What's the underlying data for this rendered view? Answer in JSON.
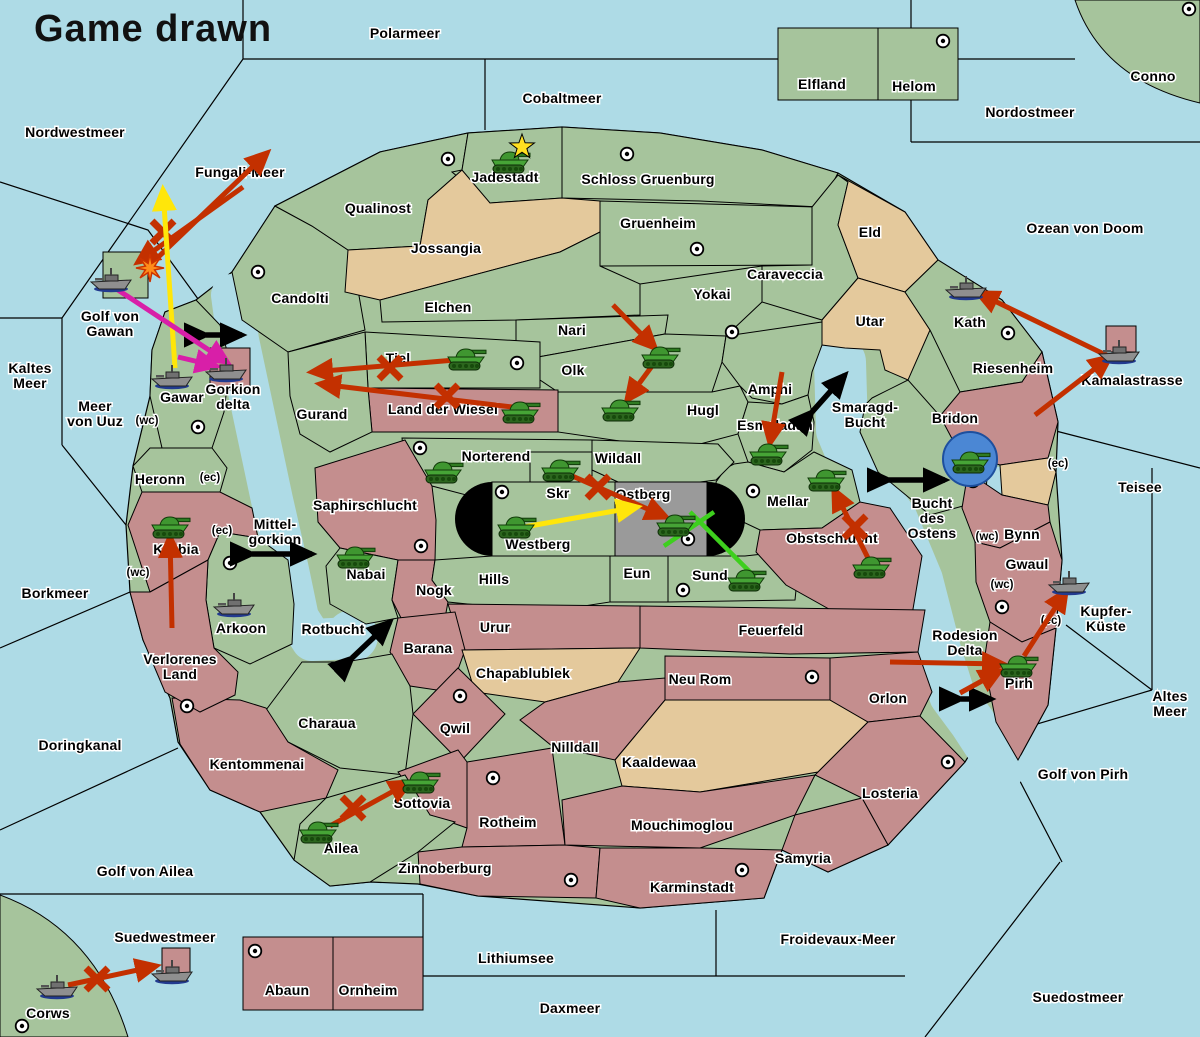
{
  "title": "Game drawn",
  "colors": {
    "ocean": "#aedbe6",
    "land_green": "#a6c49c",
    "land_tan": "#e4c99c",
    "land_red": "#c48e8e",
    "neutral_gray": "#9a9a9a",
    "arrow_red": "#c33000",
    "arrow_yellow": "#ffe60a",
    "arrow_magenta": "#d81fa8",
    "arrow_green": "#3ecf1e",
    "arrow_black": "#000000",
    "army_green": "#46a436",
    "fleet_gray": "#8f8f8f",
    "dislodged_blue": "#4b87d4",
    "star_yellow": "#ffe020",
    "explosion_orange": "#ff8c1a"
  },
  "map": {
    "sea_labels": [
      {
        "t": "Polarmeer",
        "x": 405,
        "y": 33
      },
      {
        "t": "Cobaltmeer",
        "x": 562,
        "y": 98
      },
      {
        "t": "Nordwestmeer",
        "x": 75,
        "y": 132
      },
      {
        "t": "Nordostmeer",
        "x": 1030,
        "y": 112
      },
      {
        "t": "Ozean von Doom",
        "x": 1085,
        "y": 228
      },
      {
        "t": "Fungali-Meer",
        "x": 240,
        "y": 172
      },
      {
        "lines": [
          "Kaltes",
          "Meer"
        ],
        "x": 30,
        "y": 368
      },
      {
        "lines": [
          "Golf von",
          "Gawan"
        ],
        "x": 110,
        "y": 316
      },
      {
        "lines": [
          "Meer",
          "von Uuz"
        ],
        "x": 95,
        "y": 406
      },
      {
        "t": "Borkmeer",
        "x": 55,
        "y": 593
      },
      {
        "t": "Doringkanal",
        "x": 80,
        "y": 745
      },
      {
        "t": "Golf von Ailea",
        "x": 145,
        "y": 871
      },
      {
        "t": "Suedwestmeer",
        "x": 165,
        "y": 937
      },
      {
        "t": "Lithiumsee",
        "x": 516,
        "y": 958
      },
      {
        "t": "Daxmeer",
        "x": 570,
        "y": 1008
      },
      {
        "t": "Froidevaux-Meer",
        "x": 838,
        "y": 939
      },
      {
        "t": "Suedostmeer",
        "x": 1078,
        "y": 997
      },
      {
        "t": "Golf von Pirh",
        "x": 1083,
        "y": 774
      },
      {
        "lines": [
          "Altes",
          "Meer"
        ],
        "x": 1170,
        "y": 696
      },
      {
        "t": "Teisee",
        "x": 1140,
        "y": 487
      },
      {
        "t": "Kamalastrasse",
        "x": 1132,
        "y": 380
      },
      {
        "lines": [
          "Smaragd-",
          "Bucht"
        ],
        "x": 865,
        "y": 407
      },
      {
        "lines": [
          "Bucht",
          "des",
          "Ostens"
        ],
        "x": 932,
        "y": 503
      },
      {
        "lines": [
          "Mittel-",
          "gorkion"
        ],
        "x": 275,
        "y": 524
      },
      {
        "t": "Rotbucht",
        "x": 333,
        "y": 629
      }
    ],
    "territory_labels": [
      {
        "t": "Elfland",
        "x": 822,
        "y": 84
      },
      {
        "t": "Helom",
        "x": 914,
        "y": 86
      },
      {
        "t": "Conno",
        "x": 1153,
        "y": 76
      },
      {
        "t": "Jadestadt",
        "x": 505,
        "y": 177
      },
      {
        "t": "Schloss Gruenburg",
        "x": 648,
        "y": 179
      },
      {
        "t": "Qualinost",
        "x": 378,
        "y": 208
      },
      {
        "t": "Jossangia",
        "x": 446,
        "y": 248
      },
      {
        "t": "Gruenheim",
        "x": 658,
        "y": 223
      },
      {
        "t": "Caraveccia",
        "x": 785,
        "y": 274
      },
      {
        "t": "Yokai",
        "x": 712,
        "y": 294
      },
      {
        "t": "Eld",
        "x": 870,
        "y": 232
      },
      {
        "t": "Utar",
        "x": 870,
        "y": 321
      },
      {
        "t": "Kath",
        "x": 970,
        "y": 322
      },
      {
        "t": "Riesenheim",
        "x": 1013,
        "y": 368
      },
      {
        "t": "Bridon",
        "x": 955,
        "y": 418
      },
      {
        "t": "Candolti",
        "x": 300,
        "y": 298
      },
      {
        "t": "Gurand",
        "x": 322,
        "y": 414
      },
      {
        "t": "Tiel",
        "x": 398,
        "y": 358
      },
      {
        "t": "Land der Wiesel",
        "x": 443,
        "y": 409
      },
      {
        "t": "Elchen",
        "x": 448,
        "y": 307
      },
      {
        "t": "Nari",
        "x": 572,
        "y": 330
      },
      {
        "t": "Olk",
        "x": 573,
        "y": 370
      },
      {
        "t": "Hugl",
        "x": 703,
        "y": 410
      },
      {
        "t": "Amphi",
        "x": 770,
        "y": 389
      },
      {
        "t": "Esmaladan",
        "x": 775,
        "y": 425
      },
      {
        "t": "Norterend",
        "x": 496,
        "y": 456
      },
      {
        "t": "Wildall",
        "x": 618,
        "y": 458
      },
      {
        "t": "Skr",
        "x": 558,
        "y": 493
      },
      {
        "t": "Ostberg",
        "x": 643,
        "y": 494
      },
      {
        "t": "Westberg",
        "x": 538,
        "y": 544
      },
      {
        "t": "Eun",
        "x": 637,
        "y": 573
      },
      {
        "t": "Sund",
        "x": 710,
        "y": 575
      },
      {
        "t": "Mellar",
        "x": 788,
        "y": 501
      },
      {
        "t": "Obstschlucht",
        "x": 832,
        "y": 538
      },
      {
        "t": "Gawar",
        "x": 182,
        "y": 397
      },
      {
        "lines": [
          "Gorkion",
          "delta"
        ],
        "x": 233,
        "y": 389
      },
      {
        "t": "Heronn",
        "x": 160,
        "y": 479
      },
      {
        "t": "Korbia",
        "x": 176,
        "y": 549
      },
      {
        "t": "Saphirschlucht",
        "x": 365,
        "y": 505
      },
      {
        "t": "Nabai",
        "x": 366,
        "y": 574
      },
      {
        "t": "Nogk",
        "x": 434,
        "y": 590
      },
      {
        "t": "Hills",
        "x": 494,
        "y": 579
      },
      {
        "t": "Arkoon",
        "x": 241,
        "y": 628
      },
      {
        "lines": [
          "Verlorenes",
          "Land"
        ],
        "x": 180,
        "y": 659
      },
      {
        "t": "Barana",
        "x": 428,
        "y": 648
      },
      {
        "t": "Urur",
        "x": 495,
        "y": 627
      },
      {
        "t": "Chapablublek",
        "x": 523,
        "y": 673
      },
      {
        "t": "Feuerfeld",
        "x": 771,
        "y": 630
      },
      {
        "t": "Neu Rom",
        "x": 700,
        "y": 679
      },
      {
        "t": "Qwil",
        "x": 455,
        "y": 728
      },
      {
        "t": "Nilldall",
        "x": 575,
        "y": 747
      },
      {
        "t": "Kaaldewaa",
        "x": 659,
        "y": 762
      },
      {
        "t": "Orlon",
        "x": 888,
        "y": 698
      },
      {
        "t": "Charaua",
        "x": 327,
        "y": 723
      },
      {
        "t": "Kentommenai",
        "x": 257,
        "y": 764
      },
      {
        "t": "Sottovia",
        "x": 422,
        "y": 803
      },
      {
        "t": "Ailea",
        "x": 341,
        "y": 848
      },
      {
        "t": "Rotheim",
        "x": 508,
        "y": 822
      },
      {
        "t": "Mouchimoglou",
        "x": 682,
        "y": 825
      },
      {
        "t": "Zinnoberburg",
        "x": 445,
        "y": 868
      },
      {
        "t": "Karminstadt",
        "x": 692,
        "y": 887
      },
      {
        "t": "Samyria",
        "x": 803,
        "y": 858
      },
      {
        "t": "Losteria",
        "x": 890,
        "y": 793
      },
      {
        "lines": [
          "Rodesion",
          "Delta"
        ],
        "x": 965,
        "y": 635
      },
      {
        "t": "Pirh",
        "x": 1019,
        "y": 683
      },
      {
        "t": "Gwaul",
        "x": 1027,
        "y": 564
      },
      {
        "t": "Bynn",
        "x": 1022,
        "y": 534
      },
      {
        "lines": [
          "Kupfer-",
          "Küste"
        ],
        "x": 1106,
        "y": 611
      },
      {
        "t": "Abaun",
        "x": 287,
        "y": 990
      },
      {
        "t": "Ornheim",
        "x": 368,
        "y": 990
      },
      {
        "t": "Corws",
        "x": 48,
        "y": 1013
      }
    ],
    "coast_labels": [
      {
        "t": "(wc)",
        "x": 147,
        "y": 421
      },
      {
        "t": "(ec)",
        "x": 210,
        "y": 478
      },
      {
        "t": "(ec)",
        "x": 222,
        "y": 531
      },
      {
        "t": "(wc)",
        "x": 138,
        "y": 573
      },
      {
        "t": "(ec)",
        "x": 1058,
        "y": 464
      },
      {
        "t": "(wc)",
        "x": 987,
        "y": 537
      },
      {
        "t": "(wc)",
        "x": 1002,
        "y": 585
      },
      {
        "t": "(ec)",
        "x": 1051,
        "y": 621
      }
    ],
    "supply_centers": [
      [
        448,
        159
      ],
      [
        627,
        154
      ],
      [
        943,
        41
      ],
      [
        1189,
        9
      ],
      [
        258,
        272
      ],
      [
        697,
        249
      ],
      [
        732,
        332
      ],
      [
        517,
        363
      ],
      [
        198,
        427
      ],
      [
        1008,
        333
      ],
      [
        420,
        448
      ],
      [
        502,
        492
      ],
      [
        753,
        491
      ],
      [
        688,
        539
      ],
      [
        683,
        590
      ],
      [
        421,
        546
      ],
      [
        230,
        563
      ],
      [
        973,
        481
      ],
      [
        1002,
        607
      ],
      [
        460,
        696
      ],
      [
        812,
        677
      ],
      [
        493,
        778
      ],
      [
        187,
        706
      ],
      [
        948,
        762
      ],
      [
        571,
        880
      ],
      [
        742,
        870
      ],
      [
        255,
        951
      ],
      [
        22,
        1026
      ]
    ],
    "units": [
      {
        "type": "army",
        "x": 510,
        "y": 160
      },
      {
        "type": "army",
        "x": 466,
        "y": 357
      },
      {
        "type": "army",
        "x": 520,
        "y": 410
      },
      {
        "type": "army",
        "x": 660,
        "y": 355
      },
      {
        "type": "army",
        "x": 620,
        "y": 408
      },
      {
        "type": "army",
        "x": 443,
        "y": 470
      },
      {
        "type": "army",
        "x": 560,
        "y": 468
      },
      {
        "type": "army",
        "x": 516,
        "y": 525
      },
      {
        "type": "army",
        "x": 675,
        "y": 523
      },
      {
        "type": "army",
        "x": 746,
        "y": 578
      },
      {
        "type": "army",
        "x": 768,
        "y": 452
      },
      {
        "type": "army",
        "x": 826,
        "y": 478
      },
      {
        "type": "army",
        "x": 871,
        "y": 565
      },
      {
        "type": "army",
        "x": 970,
        "y": 460
      },
      {
        "type": "army",
        "x": 170,
        "y": 525
      },
      {
        "type": "army",
        "x": 355,
        "y": 555
      },
      {
        "type": "army",
        "x": 318,
        "y": 830
      },
      {
        "type": "army",
        "x": 420,
        "y": 780
      },
      {
        "type": "army",
        "x": 1018,
        "y": 664
      },
      {
        "type": "fleet",
        "x": 112,
        "y": 280
      },
      {
        "type": "fleet",
        "x": 173,
        "y": 377
      },
      {
        "type": "fleet",
        "x": 227,
        "y": 370
      },
      {
        "type": "fleet",
        "x": 235,
        "y": 605
      },
      {
        "type": "fleet",
        "x": 967,
        "y": 288
      },
      {
        "type": "fleet",
        "x": 1120,
        "y": 352
      },
      {
        "type": "fleet",
        "x": 1070,
        "y": 583
      },
      {
        "type": "fleet",
        "x": 58,
        "y": 987
      },
      {
        "type": "fleet",
        "x": 173,
        "y": 972
      }
    ],
    "dislodged_marker": {
      "x": 970,
      "y": 459,
      "r": 27
    },
    "star": {
      "x": 522,
      "y": 147
    },
    "explosion": {
      "x": 150,
      "y": 268
    },
    "arrows": [
      {
        "color": "red",
        "from": [
          150,
          265
        ],
        "to": [
          267,
          153
        ],
        "cross": [
          163,
          232
        ]
      },
      {
        "color": "red",
        "from": [
          243,
          187
        ],
        "to": [
          138,
          262
        ]
      },
      {
        "color": "red",
        "from": [
          455,
          360
        ],
        "to": [
          312,
          372
        ],
        "cross": [
          390,
          368
        ]
      },
      {
        "color": "red",
        "from": [
          512,
          407
        ],
        "to": [
          320,
          384
        ],
        "cross": [
          447,
          396
        ]
      },
      {
        "color": "red",
        "from": [
          613,
          305
        ],
        "to": [
          655,
          348
        ]
      },
      {
        "color": "red",
        "from": [
          655,
          362
        ],
        "to": [
          627,
          400
        ]
      },
      {
        "color": "red",
        "from": [
          782,
          372
        ],
        "to": [
          770,
          443
        ]
      },
      {
        "color": "red",
        "from": [
          868,
          558
        ],
        "to": [
          834,
          490
        ],
        "cross": [
          855,
          527
        ]
      },
      {
        "color": "red",
        "from": [
          570,
          475
        ],
        "to": [
          666,
          517
        ],
        "cross": [
          598,
          487
        ]
      },
      {
        "color": "red",
        "from": [
          172,
          628
        ],
        "to": [
          170,
          537
        ]
      },
      {
        "color": "red",
        "from": [
          330,
          826
        ],
        "to": [
          410,
          782
        ],
        "cross": [
          353,
          808
        ]
      },
      {
        "color": "red",
        "from": [
          68,
          985
        ],
        "to": [
          156,
          966
        ],
        "cross": [
          97,
          979
        ]
      },
      {
        "color": "red",
        "from": [
          1108,
          356
        ],
        "to": [
          978,
          293
        ]
      },
      {
        "color": "red",
        "from": [
          1035,
          415
        ],
        "to": [
          1110,
          357
        ]
      },
      {
        "color": "red",
        "from": [
          890,
          662
        ],
        "to": [
          1003,
          664
        ]
      },
      {
        "color": "red",
        "from": [
          960,
          693
        ],
        "to": [
          1000,
          671
        ]
      },
      {
        "color": "red",
        "from": [
          1024,
          656
        ],
        "to": [
          1066,
          591
        ]
      },
      {
        "color": "yellow",
        "from": [
          175,
          368
        ],
        "to": [
          163,
          190
        ]
      },
      {
        "color": "yellow",
        "from": [
          524,
          527
        ],
        "to": [
          637,
          507
        ]
      },
      {
        "color": "magenta",
        "from": [
          112,
          286
        ],
        "to": [
          227,
          362
        ]
      },
      {
        "color": "magenta",
        "from": [
          178,
          357
        ],
        "to": [
          216,
          366
        ]
      },
      {
        "color": "green",
        "from": [
          755,
          577
        ],
        "to": [
          690,
          512
        ],
        "head": false
      },
      {
        "color": "green",
        "from": [
          664,
          546
        ],
        "to": [
          714,
          512
        ],
        "head": false
      }
    ],
    "standoff_markers": [
      {
        "from": [
          206,
          335
        ],
        "to": [
          242,
          335
        ]
      },
      {
        "from": [
          252,
          554
        ],
        "to": [
          312,
          554
        ]
      },
      {
        "from": [
          889,
          480
        ],
        "to": [
          945,
          480
        ]
      },
      {
        "from": [
          961,
          699
        ],
        "to": [
          991,
          699
        ]
      },
      {
        "from": [
          352,
          658
        ],
        "to": [
          390,
          622
        ]
      },
      {
        "from": [
          812,
          412
        ],
        "to": [
          845,
          375
        ]
      }
    ]
  }
}
